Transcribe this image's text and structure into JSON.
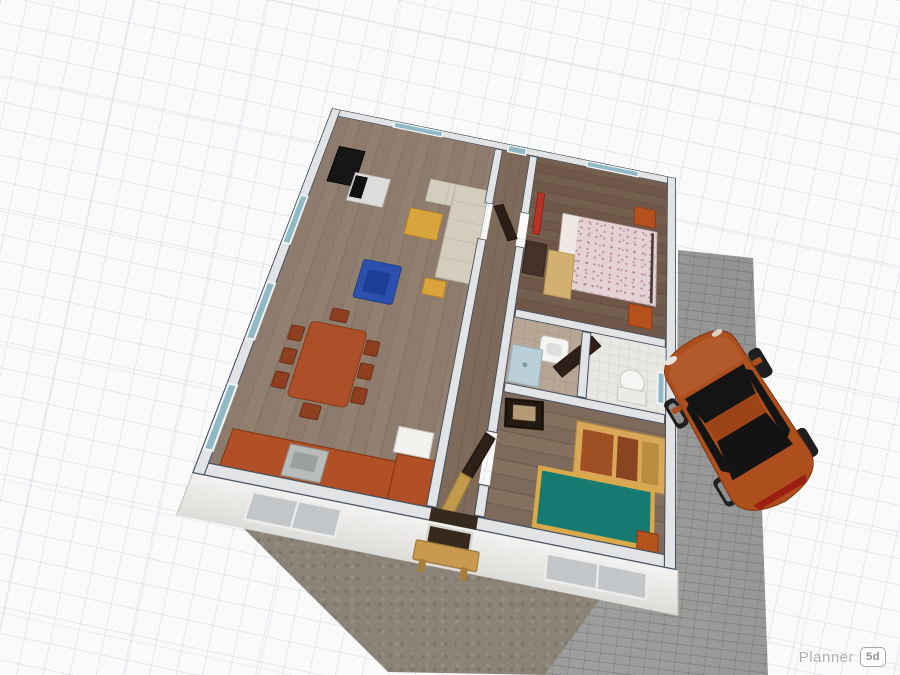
{
  "app": {
    "name": "Planner 5D floor plan editor canvas",
    "watermark_brand": "Planner",
    "watermark_badge": "5d"
  },
  "scene": {
    "view": "perspective top-down 3D render of a single-storey house on a grid ground plane",
    "house": {
      "rooms": [
        {
          "name": "living-dining-room",
          "floor": "gray-brown wood planks",
          "furniture": [
            "black-wardrobe",
            "tv-with-stand",
            "beige-corner-sofa",
            "yellow-coffee-table",
            "yellow-ottoman",
            "blue-armchair",
            "dining-table",
            "dining-chairs-x8",
            "orange-kitchen-counter",
            "kitchen-sink",
            "white-fridge"
          ],
          "windows": [
            "left-wall-window-1",
            "left-wall-window-2",
            "left-wall-window-3",
            "top-wall-window"
          ]
        },
        {
          "name": "hallway",
          "floor": "wood planks",
          "furniture": [
            "teal-wall-picture",
            "open-door-to-living",
            "open-door-to-bedroom-2",
            "open-front-door"
          ]
        },
        {
          "name": "bedroom-1",
          "floor": "dark wood planks",
          "furniture": [
            "double-bed-floral-cover",
            "metal-bed-frame",
            "orange-nightstand-north",
            "orange-nightstand-south",
            "red-radiator",
            "dark-dresser",
            "tan-rug"
          ],
          "windows": [
            "top-wall-window"
          ]
        },
        {
          "name": "bathroom-1",
          "floor": "beige tile",
          "furniture": [
            "washbasin",
            "shower-tray"
          ]
        },
        {
          "name": "bathroom-2",
          "floor": "light tile",
          "furniture": [
            "toilet",
            "open-dark-door",
            "teal-wall-picture"
          ]
        },
        {
          "name": "bedroom-2",
          "floor": "wood planks",
          "furniture": [
            "teal-single-bed-yellow-frame",
            "orange-bed-accent",
            "wood-wardrobe-unit",
            "leaning-dark-picture"
          ]
        }
      ],
      "exterior": [
        "front-facade-window-recess-left",
        "front-door-recess",
        "front-facade-window-recess-right",
        "garden-bench"
      ]
    },
    "outdoor": {
      "areas": [
        "white-grid-ground",
        "concrete-patio",
        "brick-paved-driveway"
      ],
      "vehicle": {
        "type": "sports-car",
        "color_name": "orange",
        "heading": "front toward upper-left"
      }
    }
  },
  "palette": {
    "bg": "#fafafb",
    "grid_line": "rgba(140,150,175,0.18)",
    "grid_line_major": "rgba(140,150,175,0.14)",
    "wall_fill": "#e2e3e5",
    "wall_edge": "#46505e",
    "floor_living": "#8d7c6e",
    "floor_bedroom1": "#6f584a",
    "floor_bedroom2": "#7e6a5b",
    "window_glass": "#8fb9c5",
    "sofa": "#cfc7b8",
    "coffee_table": "#d9a43c",
    "armchair_blue": "#2b50ae",
    "dining_table": "#ad4f28",
    "dining_chair": "#8d3f1f",
    "kitchen_counter": "#b14f26",
    "bed1_blanket": "#e3d1d4",
    "nightstand": "#b5511d",
    "radiator": "#b63326",
    "bed2_teal": "#177a70",
    "bed2_frame": "#d9a94a",
    "wardrobe_wood": "#d8a858",
    "wardrobe_door": "#9e4f24",
    "door_dark": "#2e2018",
    "bench": "#c89a50",
    "patio": "#8b8377",
    "brick": "#9d9d9b",
    "car_body": "#ad4e1d",
    "watermark_text": "#b0b0b0"
  }
}
